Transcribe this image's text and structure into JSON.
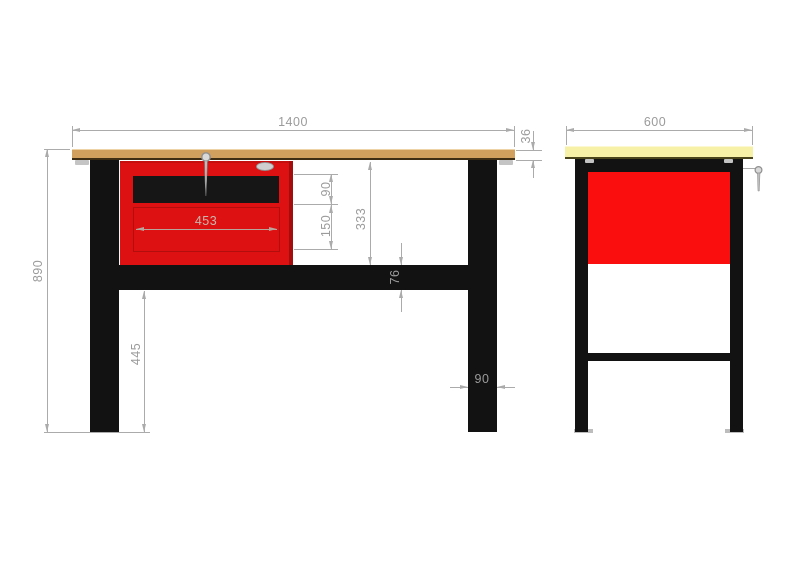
{
  "drawing": {
    "description": "Workbench dimensioned technical drawing, front and side views",
    "colors": {
      "worktop_front": "#d1a05f",
      "worktop_side": "#f6f1a6",
      "cabinet_red_front": "#dd1111",
      "cabinet_red_side": "#fb0e0e",
      "frame_black": "#121212",
      "dimension_line_gray": "#ababab",
      "dimension_text_gray": "#9b9b9b"
    },
    "front_view": {
      "dims": {
        "total_width": "1400",
        "worktop_thickness": "36",
        "total_height": "890",
        "top_drawer_height": "90",
        "bottom_drawer_height": "150",
        "drawer_front_width": "453",
        "worktop_to_stretcher": "333",
        "stretcher_height": "76",
        "floor_to_stretcher": "445",
        "leg_width": "90"
      }
    },
    "side_view": {
      "dims": {
        "total_depth": "600"
      }
    }
  }
}
